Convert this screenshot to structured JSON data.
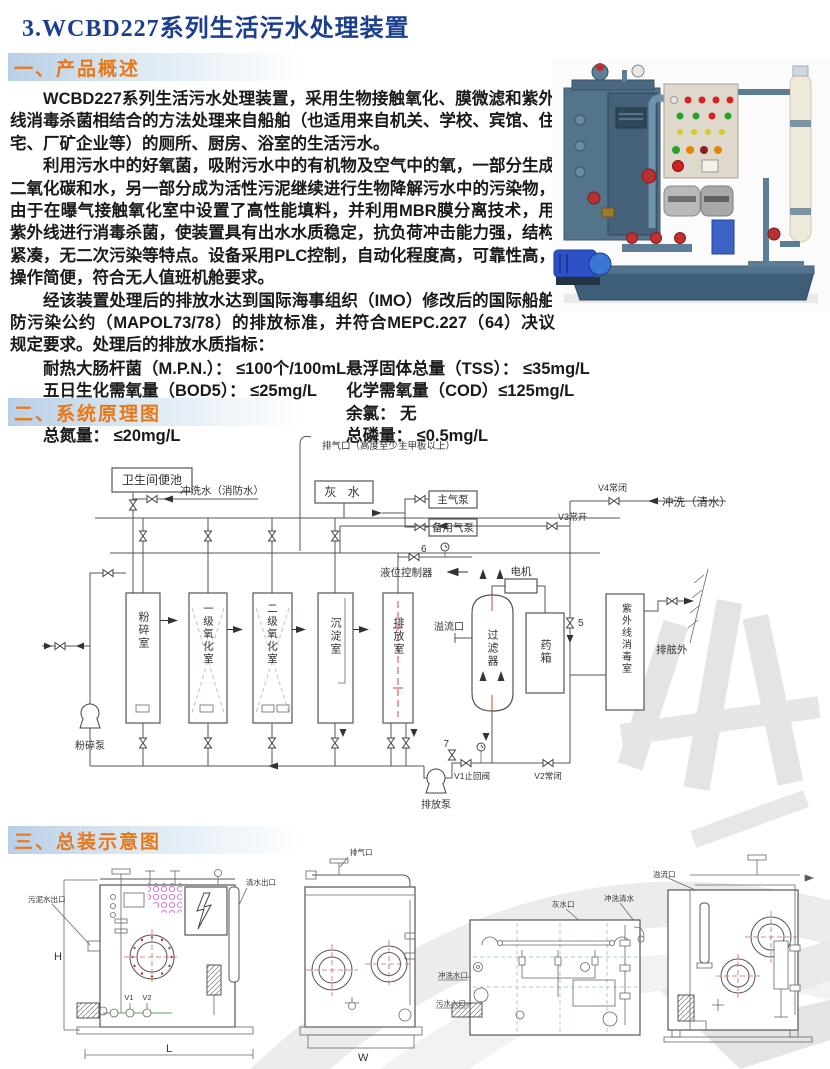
{
  "page": {
    "title": "3.WCBD227系列生活污水处理装置"
  },
  "section1": {
    "heading": "一、产品概述"
  },
  "section2": {
    "heading": "二、系统原理图"
  },
  "section3": {
    "heading": "三、总装示意图"
  },
  "overview": {
    "p1": "WCBD227系列生活污水处理装置，采用生物接触氧化、膜微滤和紫外线消毒杀菌相结合的方法处理来自船舶（也适用来自机关、学校、宾馆、住宅、厂矿企业等）的厕所、厨房、浴室的生活污水。",
    "p2": "利用污水中的好氧菌，吸附污水中的有机物及空气中的氧，一部分生成二氧化碳和水，另一部分成为活性污泥继续进行生物降解污水中的污染物，由于在曝气接触氧化室中设置了高性能填料，并利用MBR膜分离技术，用紫外线进行消毒杀菌，使装置具有出水水质稳定，抗负荷冲击能力强，结构紧凑，无二次污染等特点。设备采用PLC控制，自动化程度高，可靠性高，操作简便，符合无人值班机舱要求。",
    "p3": "经该装置处理后的排放水达到国际海事组织（IMO）修改后的国际船舶防污染公约（MAPOL73/78）的排放标准，并符合MEPC.227（64）决议规定要求。处理后的排放水质指标：",
    "ind_l1": "耐热大肠杆菌（M.P.N.）： ≤100个/100mL",
    "ind_l2": "五日生化需氧量（BOD5）： ≤25mg/L",
    "ind_l3": "pH=6~8.5",
    "ind_l4": "总氮量： ≤20mg/L",
    "ind_r1": "悬浮固体总量（TSS）： ≤35mg/L",
    "ind_r2": "化学需氧量（COD）≤125mg/L",
    "ind_r3": "余氯： 无",
    "ind_r4": "总磷量： ≤0.5mg/L"
  },
  "schematic": {
    "vent": "排气口（高度至少主甲板以上）",
    "toilet": "卫生间便池",
    "flush_fire": "冲洗水（消防水）",
    "grey_water": "灰 水",
    "main_air_pump": "主气泵",
    "backup_air_pump": "备用气泵",
    "v4": "V4常闭",
    "flush_clean": "冲洗（清水）",
    "v3": "V3常开",
    "n6": "6",
    "level_controller": "液位控制器",
    "motor": "电机",
    "tank_crush": "粉碎室",
    "tank_ox1": "一级氧化室",
    "tank_ox2": "二级氧化室",
    "tank_sed": "沉淀室",
    "tank_dis": "排放室",
    "overflow": "溢流口",
    "filter": "过滤器",
    "chem_box": "药箱",
    "uv": "紫外线消毒室",
    "overboard": "排舷外",
    "n5": "5",
    "n7": "7",
    "v1": "V1止回阀",
    "v2": "V2常闭",
    "crush_pump": "粉碎泵",
    "discharge_pump": "排放泵"
  },
  "assembly": {
    "d1_outlet": "污泥水出口",
    "d1_clean_outlet": "清水出口",
    "d1_v1": "V1",
    "d1_v2": "V2",
    "dim_h": "H",
    "dim_l": "L",
    "d2_vent": "排气口",
    "dim_w": "W",
    "d3_grey": "灰水口",
    "d3_flush": "冲洗清水",
    "d3_flush_port": "冲洗水口",
    "d3_sewage_inlet": "污水入口",
    "d4_overflow": "溢流口"
  },
  "colors": {
    "title_blue": "#1c3e8e",
    "heading_orange": "#e87818",
    "heading_bar_blue": "#b9cfe6",
    "diagram_line": "#555555",
    "media_green": "#a8d4a8",
    "gauge_red": "#cc4444",
    "honeycomb_pink": "#d868c8",
    "machine_steel_blue": "#54748c",
    "pump_blue": "#2d52c8"
  }
}
